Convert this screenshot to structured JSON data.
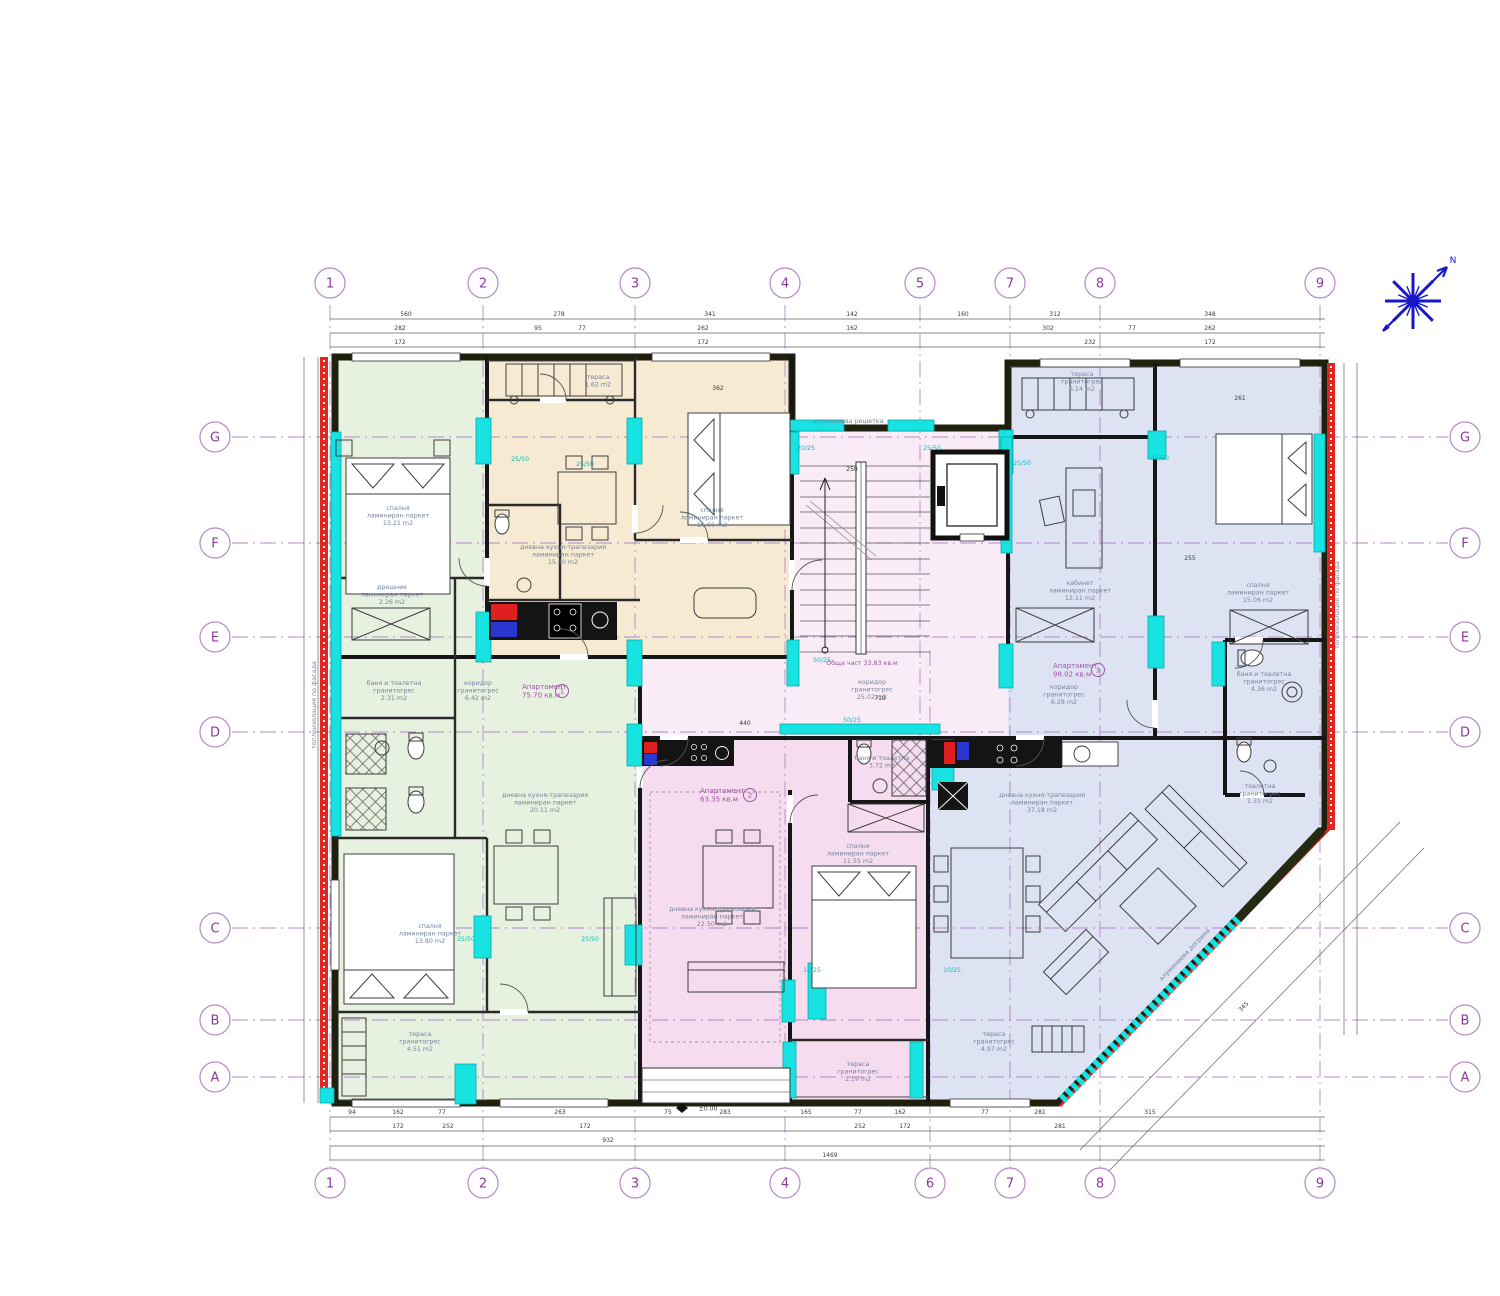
{
  "colors": {
    "green": "#e7f1df",
    "beige": "#f6ead3",
    "common": "#f9ecf7",
    "pink": "#f6dcef",
    "blue": "#dee3f4",
    "cyan": "#17e3e3",
    "cyan_dark": "#0aa8a8",
    "red": "#e2251f",
    "grid": "#b488c9",
    "grid_label": "#8b3a9b",
    "room_text": "#76839e",
    "purple_text": "#a052a8",
    "cyan_text": "#00c2c2",
    "dim_text": "#3b3b3b",
    "wall": "#20200f",
    "compass": "#1717c8"
  },
  "grid": {
    "cols_top": [
      {
        "label": "1",
        "x": 330
      },
      {
        "label": "2",
        "x": 483
      },
      {
        "label": "3",
        "x": 635
      },
      {
        "label": "4",
        "x": 785
      },
      {
        "label": "5",
        "x": 920
      },
      {
        "label": "7",
        "x": 1010
      },
      {
        "label": "8",
        "x": 1100
      },
      {
        "label": "9",
        "x": 1320
      }
    ],
    "cols_bottom": [
      {
        "label": "1",
        "x": 330
      },
      {
        "label": "2",
        "x": 483
      },
      {
        "label": "3",
        "x": 635
      },
      {
        "label": "4",
        "x": 785
      },
      {
        "label": "6",
        "x": 930
      },
      {
        "label": "7",
        "x": 1010
      },
      {
        "label": "8",
        "x": 1100
      },
      {
        "label": "9",
        "x": 1320
      }
    ],
    "rows_left": [
      {
        "label": "G",
        "y": 437
      },
      {
        "label": "F",
        "y": 543
      },
      {
        "label": "E",
        "y": 637
      },
      {
        "label": "D",
        "y": 732
      },
      {
        "label": "C",
        "y": 928
      },
      {
        "label": "B",
        "y": 1020
      },
      {
        "label": "A",
        "y": 1077
      }
    ],
    "rows_right": [
      {
        "label": "G",
        "y": 437
      },
      {
        "label": "F",
        "y": 543
      },
      {
        "label": "E",
        "y": 637
      },
      {
        "label": "D",
        "y": 732
      },
      {
        "label": "C",
        "y": 928
      },
      {
        "label": "B",
        "y": 1020
      },
      {
        "label": "A",
        "y": 1077
      }
    ],
    "vlines": [
      {
        "x": 330,
        "y1": 305,
        "y2": 1167
      },
      {
        "x": 483,
        "y1": 305,
        "y2": 1167
      },
      {
        "x": 635,
        "y1": 305,
        "y2": 1167
      },
      {
        "x": 785,
        "y1": 305,
        "y2": 1167
      },
      {
        "x": 920,
        "y1": 305,
        "y2": 745
      },
      {
        "x": 930,
        "y1": 650,
        "y2": 1167
      },
      {
        "x": 1010,
        "y1": 305,
        "y2": 1167
      },
      {
        "x": 1100,
        "y1": 305,
        "y2": 1167
      },
      {
        "x": 1320,
        "y1": 305,
        "y2": 1167
      }
    ],
    "hlines": [
      {
        "y": 437,
        "x1": 232,
        "x2": 1448
      },
      {
        "y": 543,
        "x1": 232,
        "x2": 1448
      },
      {
        "y": 637,
        "x1": 232,
        "x2": 1448
      },
      {
        "y": 732,
        "x1": 232,
        "x2": 1448
      },
      {
        "y": 928,
        "x1": 232,
        "x2": 1448
      },
      {
        "y": 1020,
        "x1": 232,
        "x2": 1448
      },
      {
        "y": 1077,
        "x1": 232,
        "x2": 1448
      }
    ]
  },
  "apartments": [
    {
      "name": "Апартамент",
      "area": "75.70 кв.м",
      "num": "1",
      "x": 522,
      "y": 689,
      "ncx": 562,
      "ncy": 691
    },
    {
      "name": "Апартамент",
      "area": "63.35 кв.м",
      "num": "2",
      "x": 700,
      "y": 793,
      "ncx": 750,
      "ncy": 795
    },
    {
      "name": "Апартамент",
      "area": "98.02 кв.м",
      "num": "3",
      "x": 1053,
      "y": 668,
      "ncx": 1098,
      "ncy": 670
    }
  ],
  "room_labels": [
    {
      "x": 398,
      "y": 510,
      "lines": [
        "спалня",
        "ламиниран паркет",
        "13.21 m2"
      ]
    },
    {
      "x": 392,
      "y": 589,
      "lines": [
        "дрешник",
        "ламиниран паркет",
        "2.26 m2"
      ]
    },
    {
      "x": 394,
      "y": 685,
      "lines": [
        "баня и тоалетна",
        "гранитогрес",
        "2.31 m2"
      ]
    },
    {
      "x": 478,
      "y": 685,
      "lines": [
        "коридор",
        "гранитогрес",
        "6.42 m2"
      ]
    },
    {
      "x": 545,
      "y": 797,
      "lines": [
        "дневна кухня-трапезария",
        "ламиниран паркет",
        "20.11 m2"
      ]
    },
    {
      "x": 430,
      "y": 928,
      "lines": [
        "спалня",
        "ламиниран паркет",
        "13.80 m2"
      ]
    },
    {
      "x": 420,
      "y": 1036,
      "lines": [
        "тераса",
        "гранитогрес",
        "4.51 m2"
      ]
    },
    {
      "x": 563,
      "y": 549,
      "lines": [
        "дневна кухня-трапезария",
        "ламиниран паркет",
        "15.60 m2"
      ]
    },
    {
      "x": 598,
      "y": 379,
      "lines": [
        "тераса",
        "1.62 m2"
      ]
    },
    {
      "x": 712,
      "y": 512,
      "lines": [
        "спалня",
        "ламиниран паркет",
        "15.66 m2"
      ]
    },
    {
      "x": 872,
      "y": 684,
      "lines": [
        "коридор",
        "гранитогрес",
        "25.02 m2"
      ]
    },
    {
      "x": 848,
      "y": 423,
      "lines": [
        "алуминиева решетка"
      ]
    },
    {
      "x": 712,
      "y": 911,
      "lines": [
        "дневна кухня-трапезария",
        "ламиниран паркет",
        "22.50 m2"
      ]
    },
    {
      "x": 858,
      "y": 848,
      "lines": [
        "спалня",
        "ламиниран паркет",
        "11.55 m2"
      ]
    },
    {
      "x": 882,
      "y": 760,
      "lines": [
        "баня и тоалетна",
        "3.72 m2"
      ]
    },
    {
      "x": 858,
      "y": 1066,
      "lines": [
        "тераса",
        "гранитогрес",
        "2.19 m2"
      ]
    },
    {
      "x": 1082,
      "y": 376,
      "lines": [
        "тераса",
        "гранитогрес",
        "6.14 m2"
      ]
    },
    {
      "x": 1080,
      "y": 585,
      "lines": [
        "кабинет",
        "ламиниран паркет",
        "12.11 m2"
      ]
    },
    {
      "x": 1258,
      "y": 587,
      "lines": [
        "спалня",
        "ламиниран паркет",
        "15.06 m2"
      ]
    },
    {
      "x": 1064,
      "y": 689,
      "lines": [
        "коридор",
        "гранитогрес",
        "6.28 m2"
      ]
    },
    {
      "x": 1264,
      "y": 676,
      "lines": [
        "баня и тоалетна",
        "гранитогрес",
        "4.36 m2"
      ]
    },
    {
      "x": 1260,
      "y": 788,
      "lines": [
        "тоалетна",
        "гранитогрес",
        "1.31 m2"
      ]
    },
    {
      "x": 1042,
      "y": 797,
      "lines": [
        "дневна кухня-трапезария",
        "ламиниран паркет",
        "37.18 m2"
      ]
    },
    {
      "x": 994,
      "y": 1036,
      "lines": [
        "тераса",
        "гранитогрес",
        "4.97 m2"
      ]
    },
    {
      "x": 1186,
      "y": 956,
      "lines": [
        "алуминиева дограма"
      ],
      "r": -46
    },
    {
      "x": 1339,
      "y": 605,
      "lines": [
        "топлоизолация по фасада"
      ],
      "r": -90
    },
    {
      "x": 316,
      "y": 705,
      "lines": [
        "топлоизолация по фасада"
      ],
      "r": -90
    },
    {
      "x": 862,
      "y": 665,
      "lines": [
        "Обща част  33.83 кв.м"
      ],
      "c": "purple"
    }
  ],
  "column_labels": [
    {
      "t": "25/50",
      "x": 520,
      "y": 461
    },
    {
      "t": "25/50",
      "x": 585,
      "y": 466
    },
    {
      "t": "20/25",
      "x": 806,
      "y": 450
    },
    {
      "t": "25/50",
      "x": 932,
      "y": 450
    },
    {
      "t": "25/50",
      "x": 1022,
      "y": 465
    },
    {
      "t": "25/50",
      "x": 1160,
      "y": 460
    },
    {
      "t": "50/25",
      "x": 822,
      "y": 662
    },
    {
      "t": "50/25",
      "x": 852,
      "y": 722
    },
    {
      "t": "25/50",
      "x": 466,
      "y": 941
    },
    {
      "t": "25/50",
      "x": 590,
      "y": 941
    },
    {
      "t": "10/25",
      "x": 812,
      "y": 972
    },
    {
      "t": "10/25",
      "x": 952,
      "y": 972
    }
  ],
  "dim_labels": [
    {
      "t": "560",
      "x": 406,
      "y": 316
    },
    {
      "t": "278",
      "x": 559,
      "y": 316
    },
    {
      "t": "341",
      "x": 710,
      "y": 316
    },
    {
      "t": "142",
      "x": 852,
      "y": 316
    },
    {
      "t": "160",
      "x": 963,
      "y": 316
    },
    {
      "t": "312",
      "x": 1055,
      "y": 316
    },
    {
      "t": "348",
      "x": 1210,
      "y": 316
    },
    {
      "t": "282",
      "x": 400,
      "y": 330
    },
    {
      "t": "95",
      "x": 538,
      "y": 330
    },
    {
      "t": "77",
      "x": 582,
      "y": 330
    },
    {
      "t": "262",
      "x": 703,
      "y": 330
    },
    {
      "t": "162",
      "x": 852,
      "y": 330
    },
    {
      "t": "302",
      "x": 1048,
      "y": 330
    },
    {
      "t": "77",
      "x": 1132,
      "y": 330
    },
    {
      "t": "262",
      "x": 1210,
      "y": 330
    },
    {
      "t": "172",
      "x": 400,
      "y": 344
    },
    {
      "t": "172",
      "x": 703,
      "y": 344
    },
    {
      "t": "232",
      "x": 1090,
      "y": 344
    },
    {
      "t": "172",
      "x": 1210,
      "y": 344
    },
    {
      "t": "94",
      "x": 352,
      "y": 1114
    },
    {
      "t": "162",
      "x": 398,
      "y": 1114
    },
    {
      "t": "77",
      "x": 442,
      "y": 1114
    },
    {
      "t": "263",
      "x": 560,
      "y": 1114
    },
    {
      "t": "75",
      "x": 668,
      "y": 1114
    },
    {
      "t": "283",
      "x": 725,
      "y": 1114
    },
    {
      "t": "165",
      "x": 806,
      "y": 1114
    },
    {
      "t": "77",
      "x": 858,
      "y": 1114
    },
    {
      "t": "162",
      "x": 900,
      "y": 1114
    },
    {
      "t": "77",
      "x": 985,
      "y": 1114
    },
    {
      "t": "281",
      "x": 1040,
      "y": 1114
    },
    {
      "t": "315",
      "x": 1150,
      "y": 1114
    },
    {
      "t": "172",
      "x": 398,
      "y": 1128
    },
    {
      "t": "252",
      "x": 448,
      "y": 1128
    },
    {
      "t": "172",
      "x": 585,
      "y": 1128
    },
    {
      "t": "252",
      "x": 860,
      "y": 1128
    },
    {
      "t": "172",
      "x": 905,
      "y": 1128
    },
    {
      "t": "281",
      "x": 1060,
      "y": 1128
    },
    {
      "t": "932",
      "x": 608,
      "y": 1142
    },
    {
      "t": "1469",
      "x": 830,
      "y": 1157
    },
    {
      "t": "250",
      "x": 852,
      "y": 471
    },
    {
      "t": "362",
      "x": 718,
      "y": 390
    },
    {
      "t": "261",
      "x": 1240,
      "y": 400
    },
    {
      "t": "255",
      "x": 1190,
      "y": 560
    },
    {
      "t": "440",
      "x": 745,
      "y": 725
    },
    {
      "t": "710",
      "x": 880,
      "y": 700
    },
    {
      "t": "345",
      "x": 1245,
      "y": 1008,
      "r": -46
    }
  ],
  "levels": [
    {
      "t": "±0.00",
      "x": 700,
      "y": 1108
    }
  ],
  "compass": {
    "north_label": "N"
  }
}
